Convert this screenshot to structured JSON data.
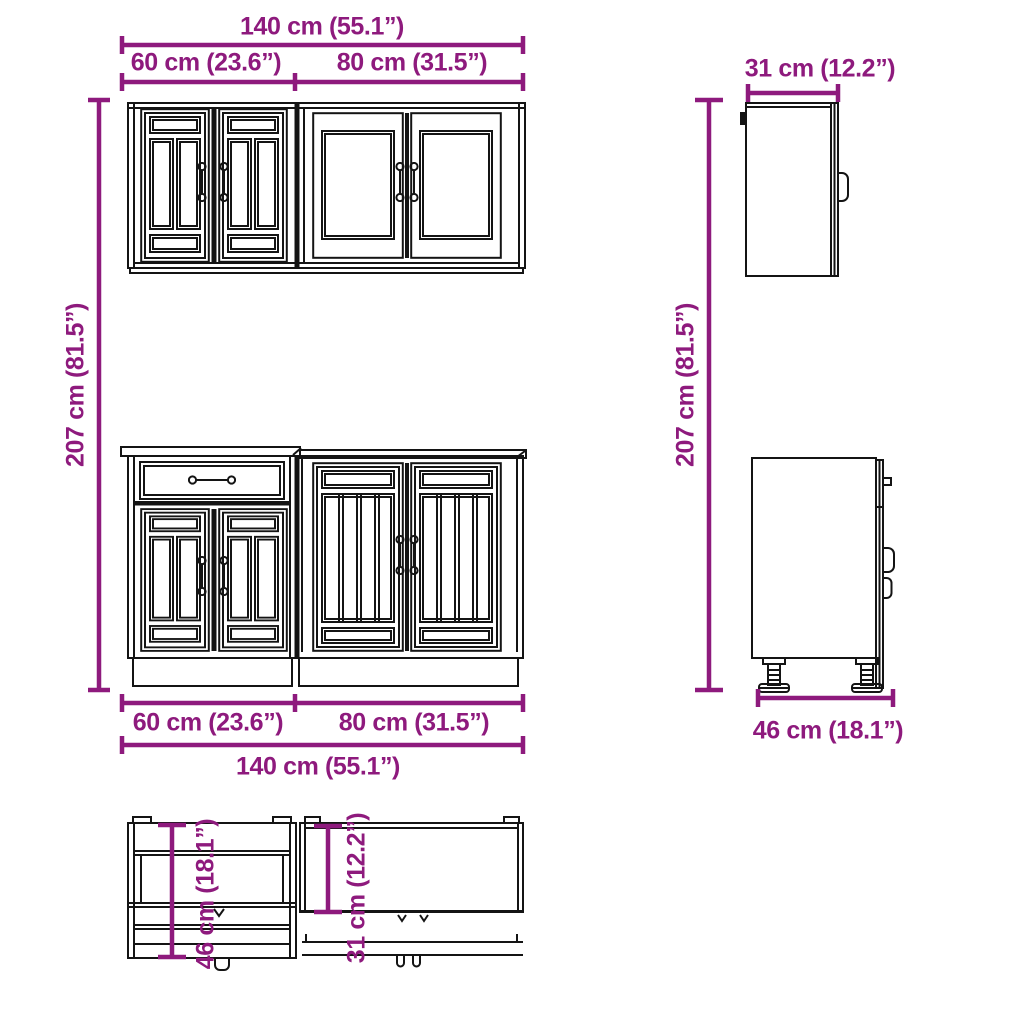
{
  "colors": {
    "dimension": "#8e1a7d",
    "line": "#141414",
    "background": "#ffffff"
  },
  "labels": {
    "front_top_total": "140 cm (55.1”)",
    "front_top_left": "60 cm (23.6”)",
    "front_top_right": "80 cm (31.5”)",
    "height_left": "207 cm (81.5”)",
    "height_right": "207 cm (81.5”)",
    "front_bottom_left": "60 cm (23.6”)",
    "front_bottom_right": "80 cm (31.5”)",
    "front_bottom_total": "140 cm (55.1”)",
    "side_top_depth": "31 cm (12.2”)",
    "side_bottom_depth": "46 cm (18.1”)",
    "plan_left_depth": "46 cm (18.1”)",
    "plan_right_depth": "31 cm (12.2”)"
  }
}
